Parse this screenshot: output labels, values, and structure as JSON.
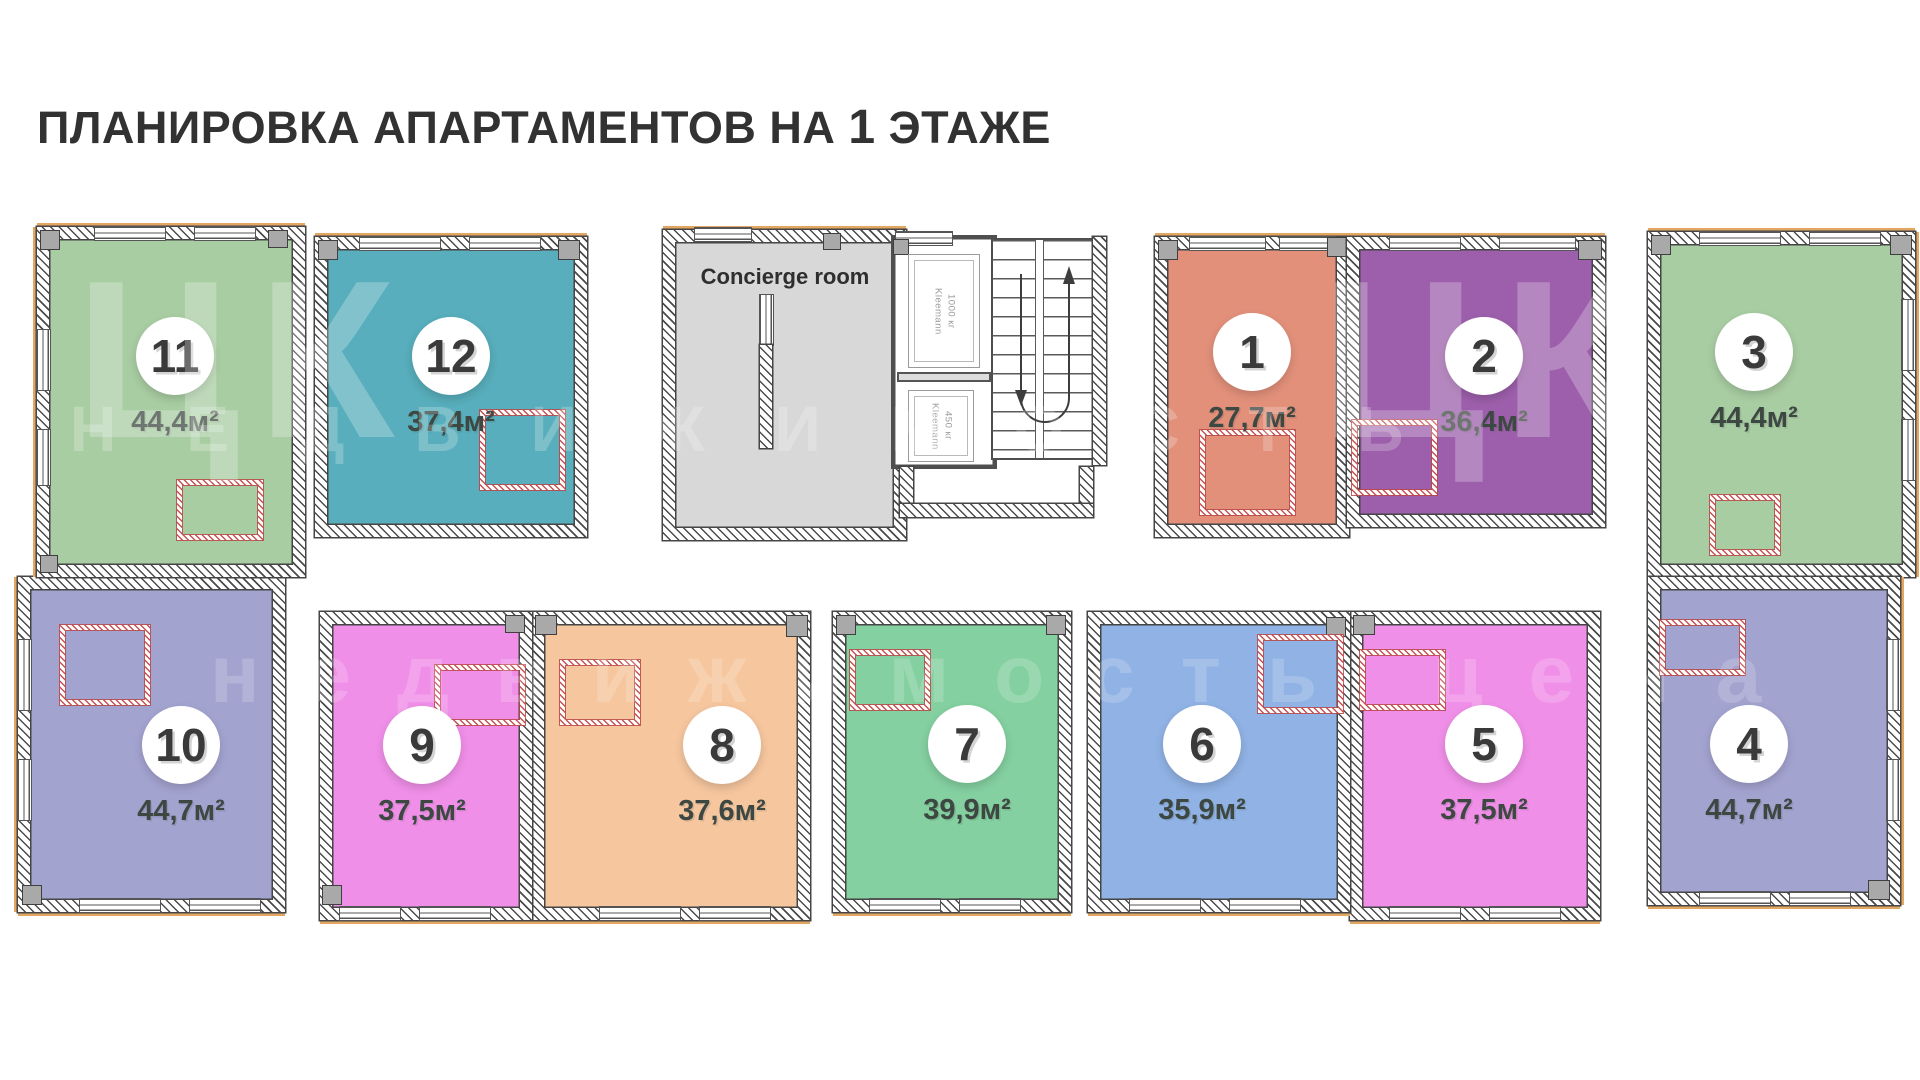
{
  "title": {
    "prefix": "ПЛАНИРОВКА АПАРТАМЕНТОВ НА",
    "number": "1",
    "suffix": "ЭТАЖЕ"
  },
  "concierge": {
    "label": "Concierge room",
    "color": "#d8d8d8"
  },
  "elevators": [
    {
      "brand": "Kleemann",
      "capacity": "1000 кг"
    },
    {
      "brand": "Kleemann",
      "capacity": "450 кг"
    }
  ],
  "watermark": {
    "logo": "ЦК",
    "row_upper": "НЕДВИЖИМОСТЬ",
    "row_lower": "недвижимость цена"
  },
  "accent_colors": {
    "outer_trim": "#e3a763",
    "wall": "#4b4b4b",
    "area_text": "#3e4842"
  },
  "apartments": [
    {
      "number": "1",
      "area": "27,7м²",
      "color": "#e2907a"
    },
    {
      "number": "2",
      "area": "36,4м²",
      "color": "#9d5fab"
    },
    {
      "number": "3",
      "area": "44,4м²",
      "color": "#a9cda3"
    },
    {
      "number": "4",
      "area": "44,7м²",
      "color": "#a3a3d0"
    },
    {
      "number": "5",
      "area": "37,5м²",
      "color": "#f08fe8"
    },
    {
      "number": "6",
      "area": "35,9м²",
      "color": "#90b2e4"
    },
    {
      "number": "7",
      "area": "39,9м²",
      "color": "#84d0a0"
    },
    {
      "number": "8",
      "area": "37,6м²",
      "color": "#f6c69e"
    },
    {
      "number": "9",
      "area": "37,5м²",
      "color": "#f08fe8"
    },
    {
      "number": "10",
      "area": "44,7м²",
      "color": "#a3a3d0"
    },
    {
      "number": "11",
      "area": "44,4м²",
      "color": "#a9cda3"
    },
    {
      "number": "12",
      "area": "37,4м²",
      "color": "#58aebc"
    }
  ]
}
